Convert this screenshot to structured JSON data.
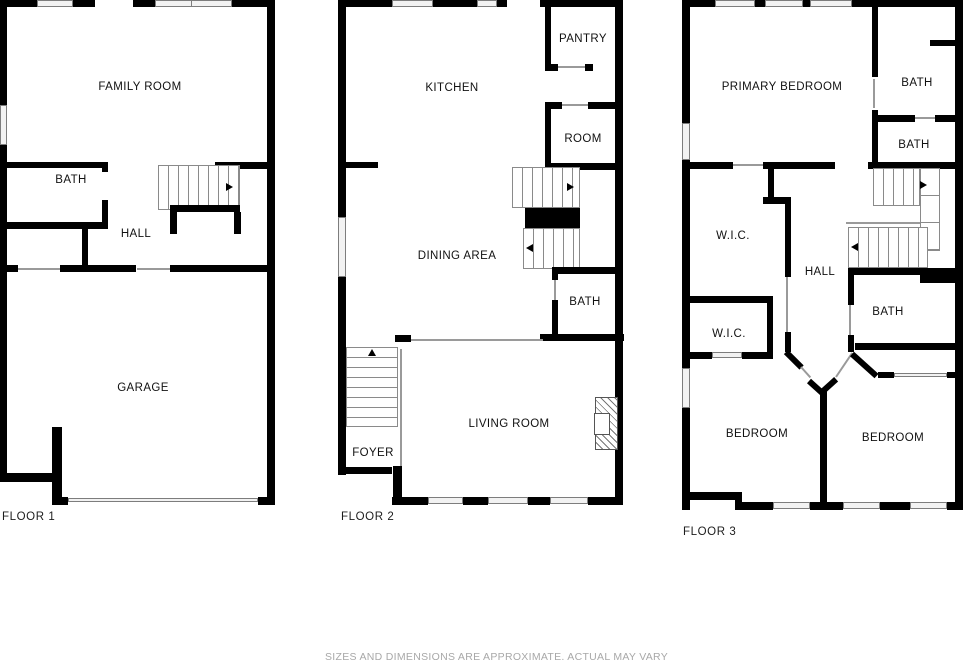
{
  "floors": [
    {
      "name": "FLOOR 1",
      "rooms": [
        "FAMILY ROOM",
        "BATH",
        "HALL",
        "GARAGE"
      ]
    },
    {
      "name": "FLOOR 2",
      "rooms": [
        "KITCHEN",
        "PANTRY",
        "ROOM",
        "DINING AREA",
        "BATH",
        "FOYER",
        "LIVING ROOM"
      ]
    },
    {
      "name": "FLOOR 3",
      "rooms": [
        "PRIMARY BEDROOM",
        "BATH",
        "BATH",
        "W.I.C.",
        "HALL",
        "W.I.C.",
        "BATH",
        "BEDROOM",
        "BEDROOM"
      ]
    }
  ],
  "disclaimer": "SIZES AND DIMENSIONS ARE APPROXIMATE, ACTUAL MAY VARY",
  "colors": {
    "wall": "#000000",
    "window_fill": "#f2f2f2",
    "window_border": "#7d7d7d",
    "stair_line": "#8a8a8a",
    "room_label": "#111111",
    "floor_label": "#1c1c1c",
    "disclaimer_text": "#a8a8a8",
    "background": "#ffffff"
  }
}
